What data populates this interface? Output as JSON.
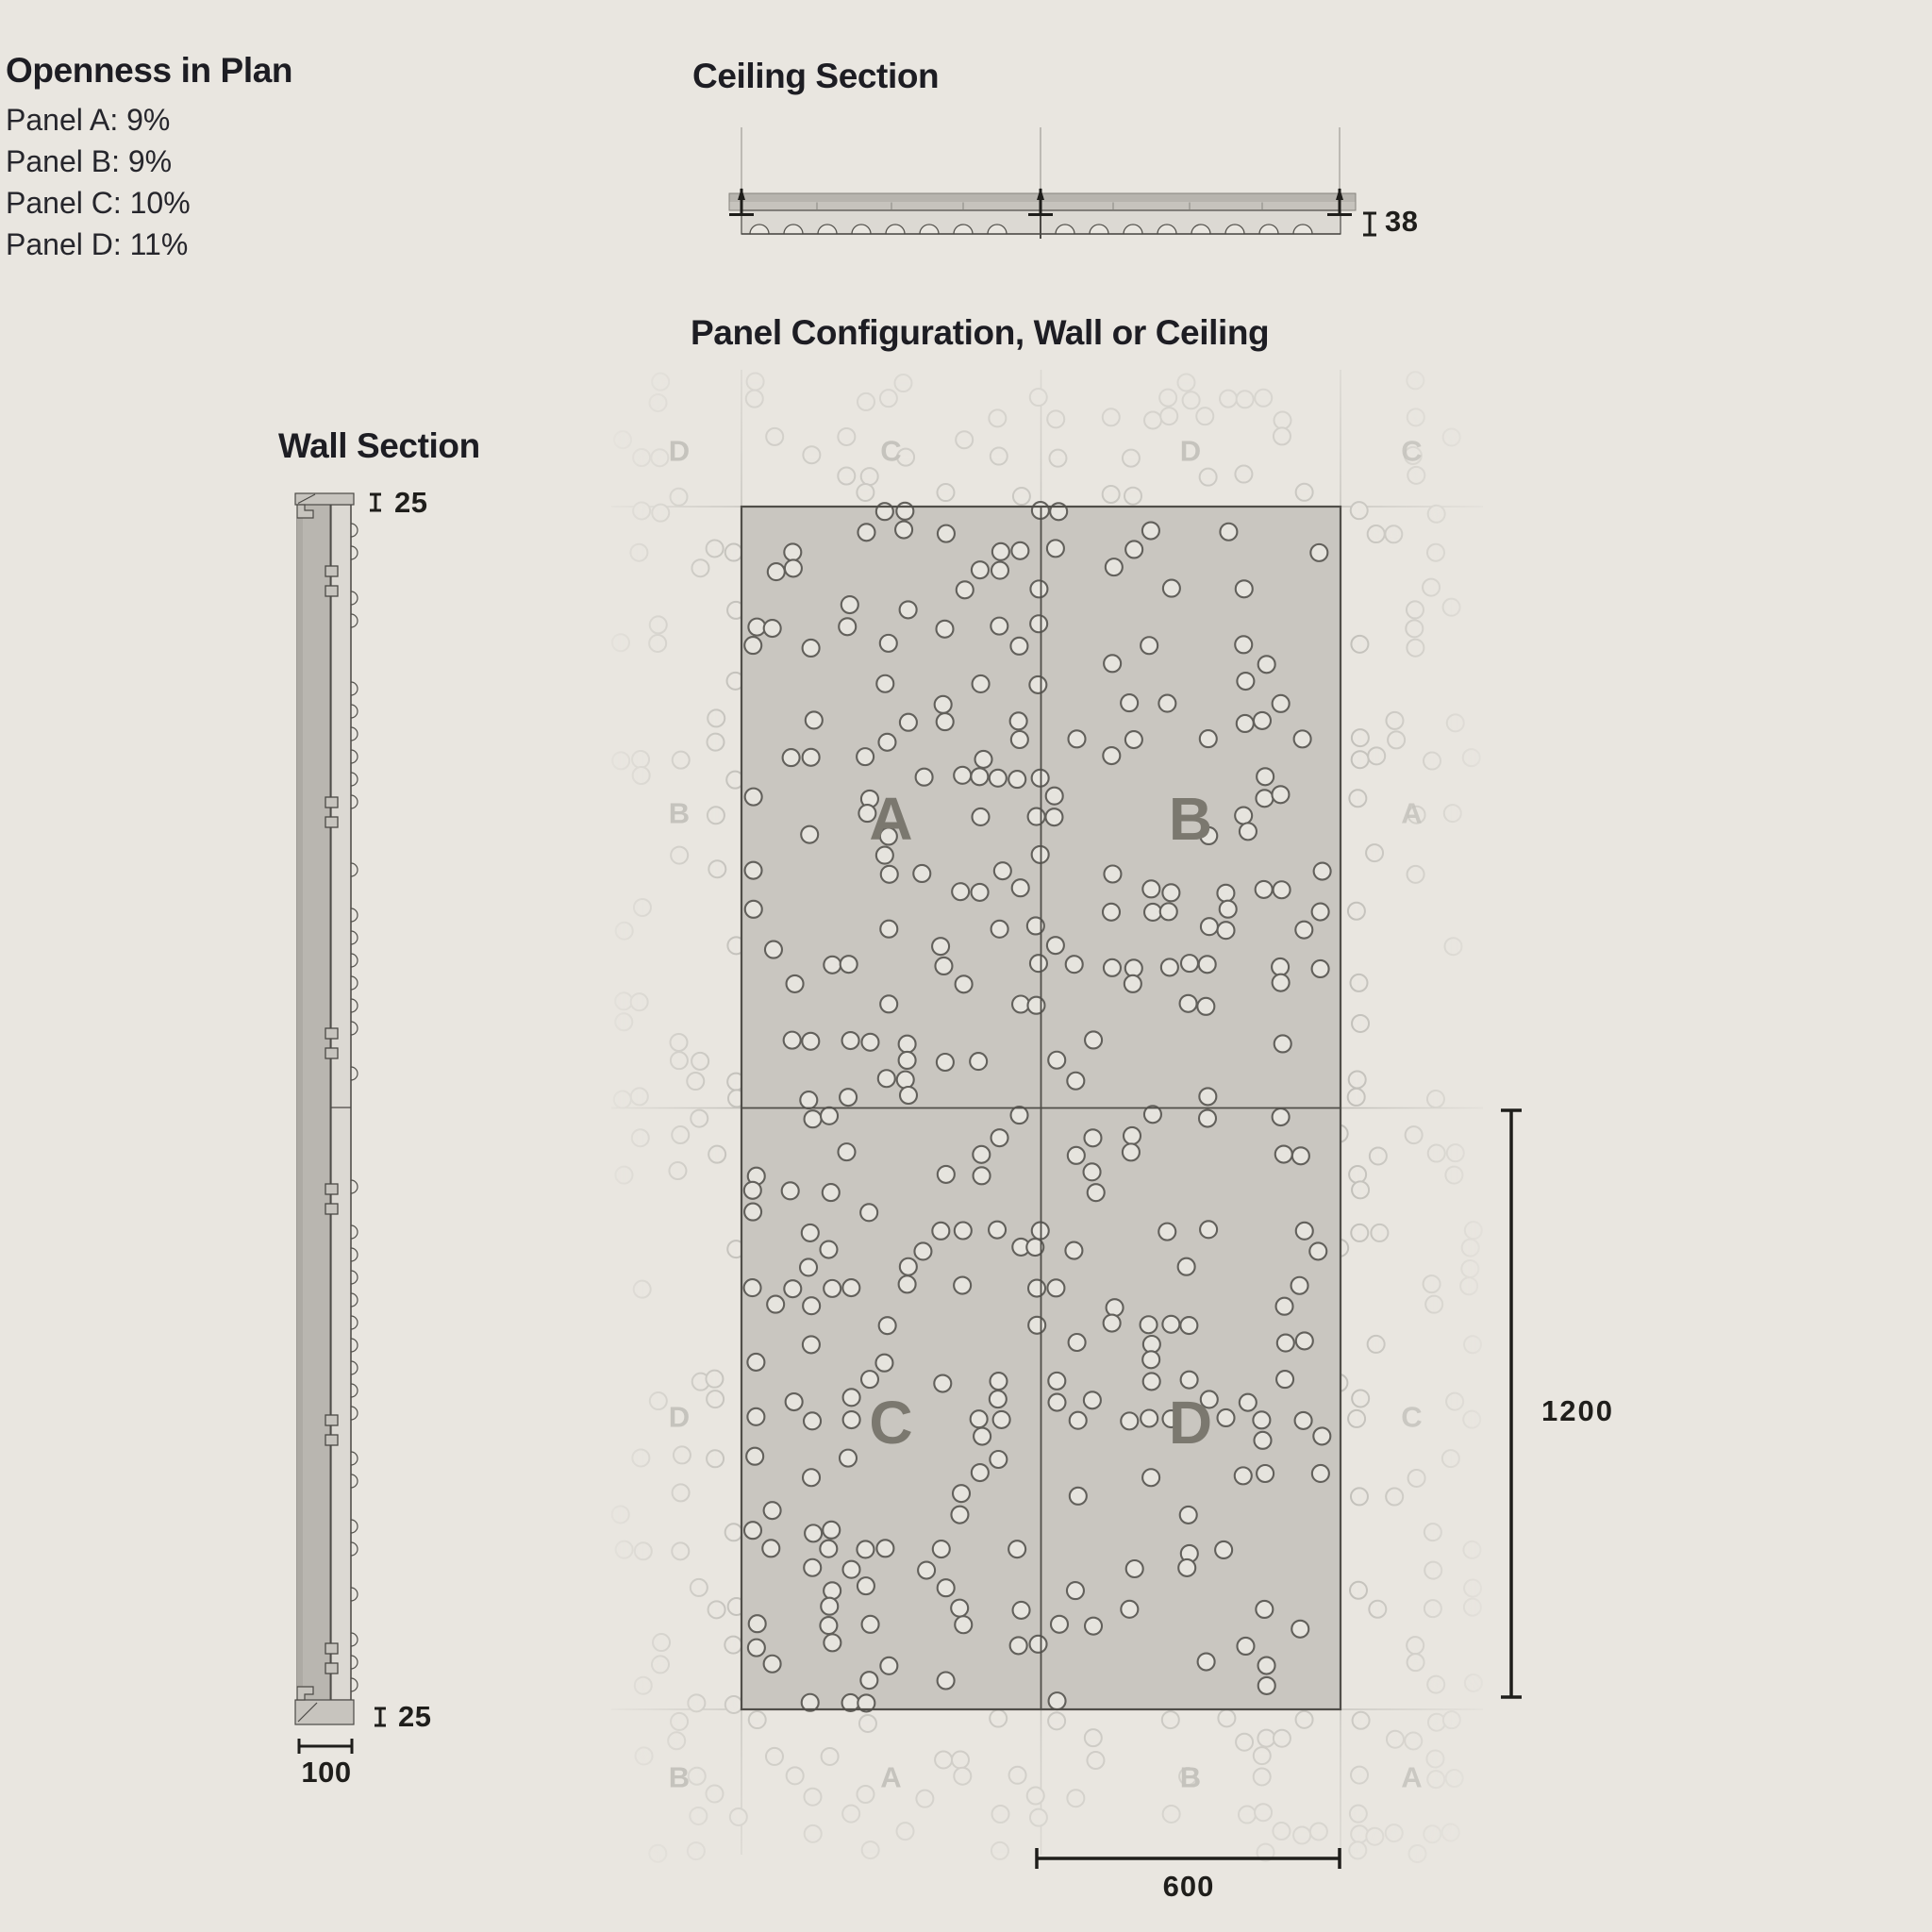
{
  "openness": {
    "title": "Openness in Plan",
    "items": [
      "Panel A: 9%",
      "Panel B: 9%",
      "Panel C: 10%",
      "Panel D: 11%"
    ]
  },
  "ceiling_section": {
    "title": "Ceiling Section",
    "thickness_dim": "38"
  },
  "wall_section": {
    "title": "Wall Section",
    "panel_thickness_dim_top": "25",
    "panel_thickness_dim_bottom": "25",
    "depth_dim": "100"
  },
  "panel_config": {
    "title": "Panel Configuration, Wall or Ceiling",
    "highlight_grid": [
      [
        "A",
        "B"
      ],
      [
        "C",
        "D"
      ]
    ],
    "surround": {
      "top": [
        "D",
        "C",
        "D",
        "C"
      ],
      "left": [
        "B",
        "D"
      ],
      "right": [
        "A",
        "C"
      ],
      "bottom": [
        "B",
        "A",
        "B",
        "A"
      ]
    },
    "panel_width_dim": "600",
    "panel_height_dim": "1200"
  },
  "pattern": {
    "dot_radius": 9,
    "pitch": 20,
    "seed": 11,
    "density_faded": 0.15,
    "density_by_panel": {
      "A": 0.14,
      "B": 0.14,
      "C": 0.155,
      "D": 0.17
    }
  },
  "colors": {
    "bg": "#e9e6e0",
    "ink": "#1d1d23",
    "dim": "#1f1e1b",
    "panel_fill": "#c9c6c0",
    "panel_border": "#504e49",
    "dot_stroke": "#62605b",
    "dot_fill": "#e6e4de",
    "faded_stroke": "#c2c0ba",
    "grid_line": "#c2c0ba",
    "highlight_letter": "#7b786f",
    "faded_letter": "#c5c3bd",
    "section_dark": "#b9b6b0",
    "section_dark_edge": "#adaaa4",
    "section_mid": "#c7c4be",
    "section_light": "#dcd9d3",
    "section_outline": "#4b4945",
    "carrier_top": "#b7b4ae",
    "carrier_bottom": "#c6c3bd",
    "carrier_outline": "#85837d",
    "wire": "#aeaca6",
    "scallop_stroke": "#55534e"
  }
}
